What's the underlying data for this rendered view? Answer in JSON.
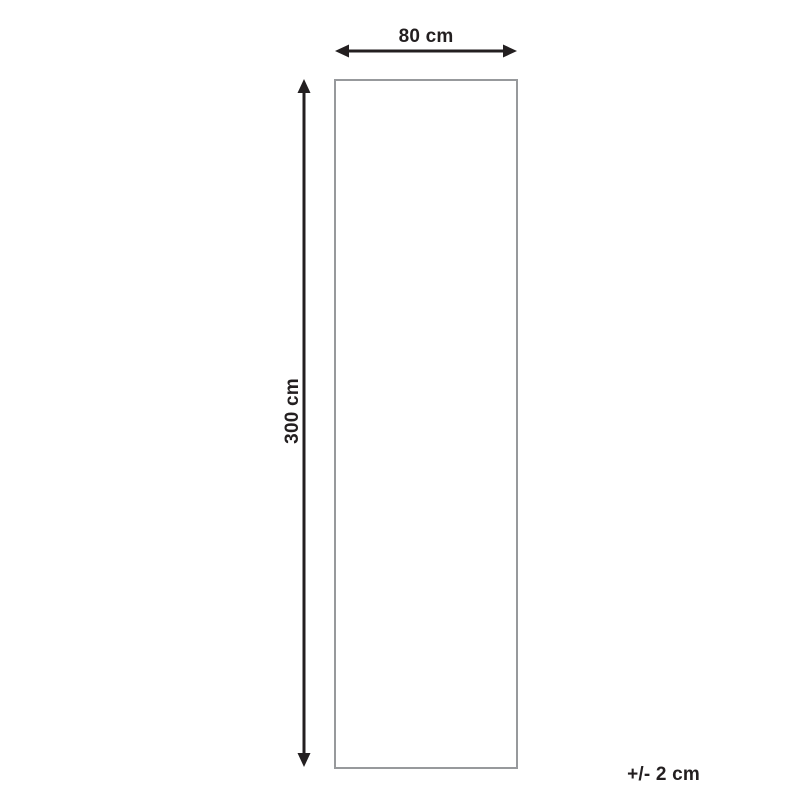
{
  "diagram": {
    "type": "product-dimension-diagram",
    "width_label": "80 cm",
    "height_label": "300 cm",
    "tolerance_label": "+/- 2 cm",
    "colors": {
      "arrow": "#231f20",
      "text": "#231f20",
      "outline": "#97999c",
      "background": "#ffffff"
    }
  }
}
